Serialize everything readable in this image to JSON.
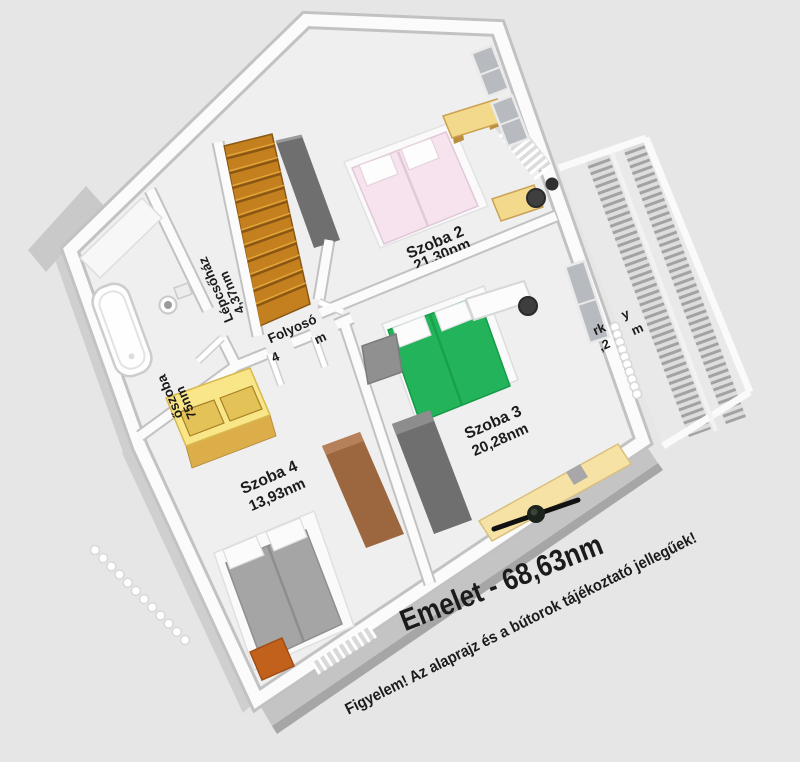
{
  "title": "Emelet - 68,63nm",
  "disclaimer": "Figyelem! Az alaprajz és a bútorok tájékoztató jellegűek!",
  "rooms": {
    "szoba2": {
      "name": "Szoba 2",
      "area": "21,30nm"
    },
    "szoba3": {
      "name": "Szoba 3",
      "area": "20,28nm"
    },
    "szoba4": {
      "name": "Szoba 4",
      "area": "13,93nm"
    },
    "lepcsohaz": {
      "name": "Lépcsőház",
      "area": "4,37nm"
    },
    "folyoso": {
      "name": "Folyosó",
      "area_fragment_left": "4",
      "area_fragment_right": "m"
    },
    "furdoszoba": {
      "name_fragment": "őszoba",
      "area_fragment": "75nm"
    },
    "erkely": {
      "fragment_top_left": "rk",
      "fragment_top_right": "y",
      "fragment_bottom_left": ",2",
      "fragment_bottom_right": "m"
    }
  },
  "colors": {
    "background": "#e6e6e6",
    "floor": "#efefef",
    "wall": "#fbfbfb",
    "stairs": "#c4801f",
    "bed_pink": "#f6e3ee",
    "bed_green": "#23b45b",
    "bed_gray": "#a5a5a5",
    "furniture_yellow": "#f3d98b",
    "sofa_yellow": "#f6e2a5",
    "cabinet_brown": "#9c673f",
    "wardrobe_dark": "#6f6f6f",
    "nightstand_orange": "#c2611c"
  }
}
